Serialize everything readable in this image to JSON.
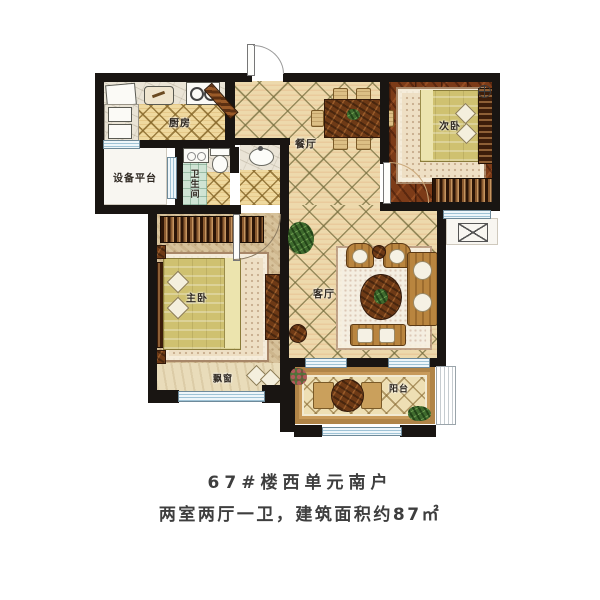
{
  "plan": {
    "rooms": {
      "kitchen": "厨房",
      "dining": "餐厅",
      "second_bedroom": "次卧",
      "equipment_platform": "设备平台",
      "bathroom": "卫生间",
      "master_bedroom": "主卧",
      "living_room": "客厅",
      "bay_window": "飘窗",
      "balcony": "阳台"
    },
    "colors": {
      "wall": "#191512",
      "tile_floor": "#edd9ac",
      "wood_floor": "#7c3b18",
      "master_floor": "#d7c29b",
      "bedding": "#cfc170",
      "window_blue": "#bcd8e6",
      "bath_green": "#cfe4d4"
    }
  },
  "caption": {
    "line1": "67#楼西单元南户",
    "line2": "两室两厅一卫，建筑面积约87㎡"
  }
}
